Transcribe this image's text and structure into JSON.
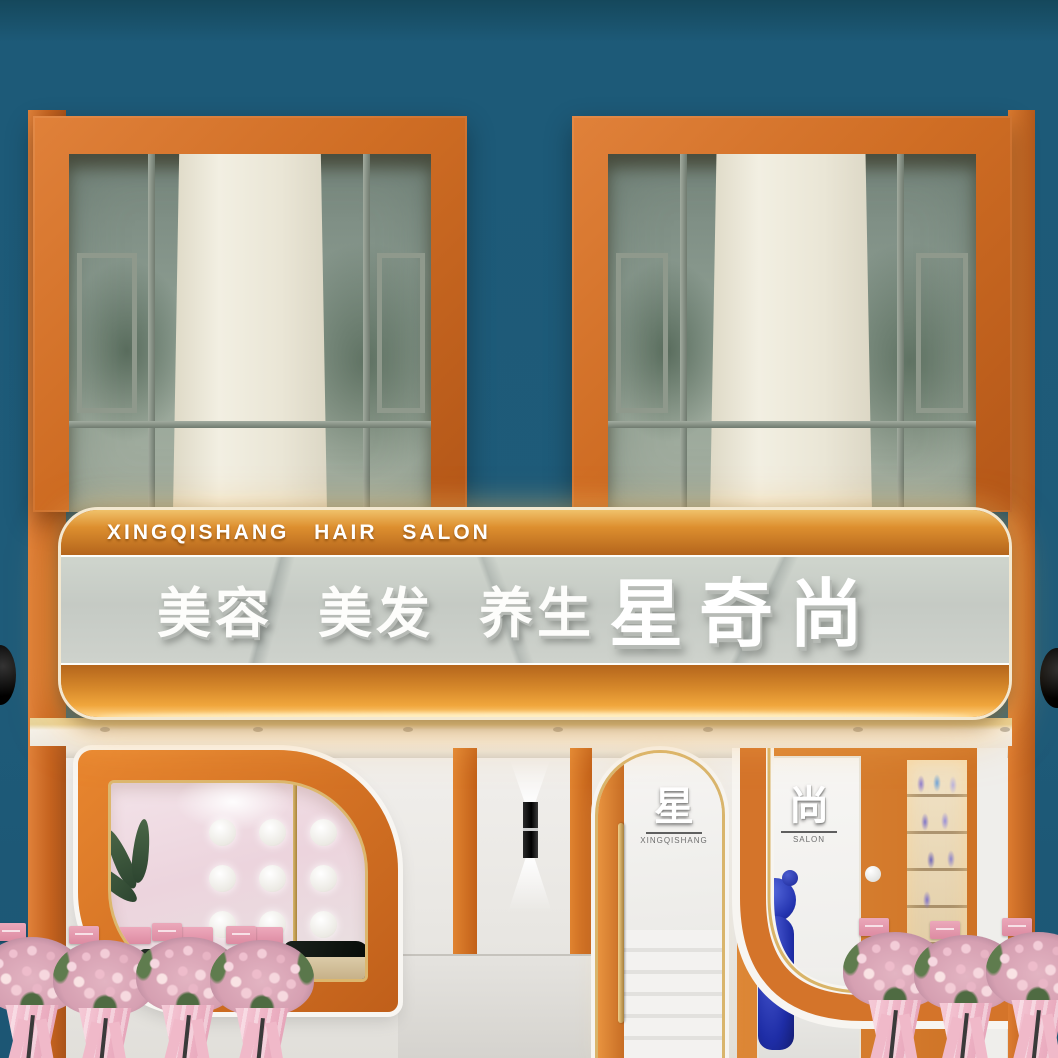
{
  "sign": {
    "top_text": "XINGQISHANG HAIR SALON",
    "services_text": "美容 美发 养生",
    "brand_text": "星奇尚"
  },
  "door": {
    "decal_char": "星",
    "decal_sub": "XINGQISHANG"
  },
  "display": {
    "decal_char": "尚",
    "decal_sub": "SALON"
  },
  "colors": {
    "wall_teal": "#1d5a78",
    "frame_orange": "#cf6f22",
    "sign_marble": "#c9cec8",
    "gold_trim": "#d9b56c",
    "sign_glow": "#ffd98e",
    "flower_pink": "#eec2cf",
    "ribbon_pink": "#f0b9c9",
    "bear_blue": "#2f3fb8",
    "curtain_cream": "#efece0"
  }
}
